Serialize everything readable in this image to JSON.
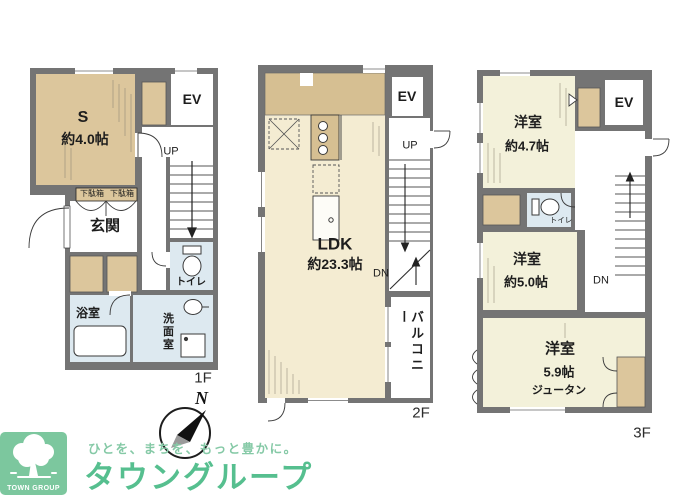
{
  "colors": {
    "wall_gray": "#747474",
    "room_tan": "#dcc69c",
    "kitchen_tan": "#d6bf92",
    "room_cream": "#f4ecd2",
    "room_pale_yellow": "#f3f1da",
    "wet_area_blue": "#dde9f0",
    "logo_square_green": "#7cc79e",
    "brand_text_green": "#56bf8f"
  },
  "floor1": {
    "floor_label": "1F",
    "storage_name": "S",
    "storage_size": "約4.0帖",
    "elevator_label": "EV",
    "stairs_label": "UP",
    "shoe_cabinet_label": "下駄箱",
    "entrance_label": "玄関",
    "toilet_label": "トイレ",
    "bathroom_label": "浴室",
    "washroom_label": "洗面室"
  },
  "floor2": {
    "floor_label": "2F",
    "ldk_name": "LDK",
    "ldk_size": "約23.3帖",
    "elevator_label": "EV",
    "stairs_up_label": "UP",
    "stairs_down_label": "DN",
    "balcony_label": "バルコニー"
  },
  "floor3": {
    "floor_label": "3F",
    "bedroom1_name": "洋室",
    "bedroom1_size": "約4.7帖",
    "elevator_label": "EV",
    "toilet_label": "トイレ",
    "bedroom2_name": "洋室",
    "bedroom2_size": "約5.0帖",
    "stairs_down_label": "DN",
    "bedroom3_name": "洋室",
    "bedroom3_size": "5.9帖",
    "bedroom3_flooring": "ジュータン"
  },
  "compass": {
    "north_label": "N"
  },
  "logo": {
    "mark_caption": "TOWN GROUP",
    "tagline": "ひとを、まちを、もっと豊かに。",
    "brand_name": "タウングループ"
  }
}
